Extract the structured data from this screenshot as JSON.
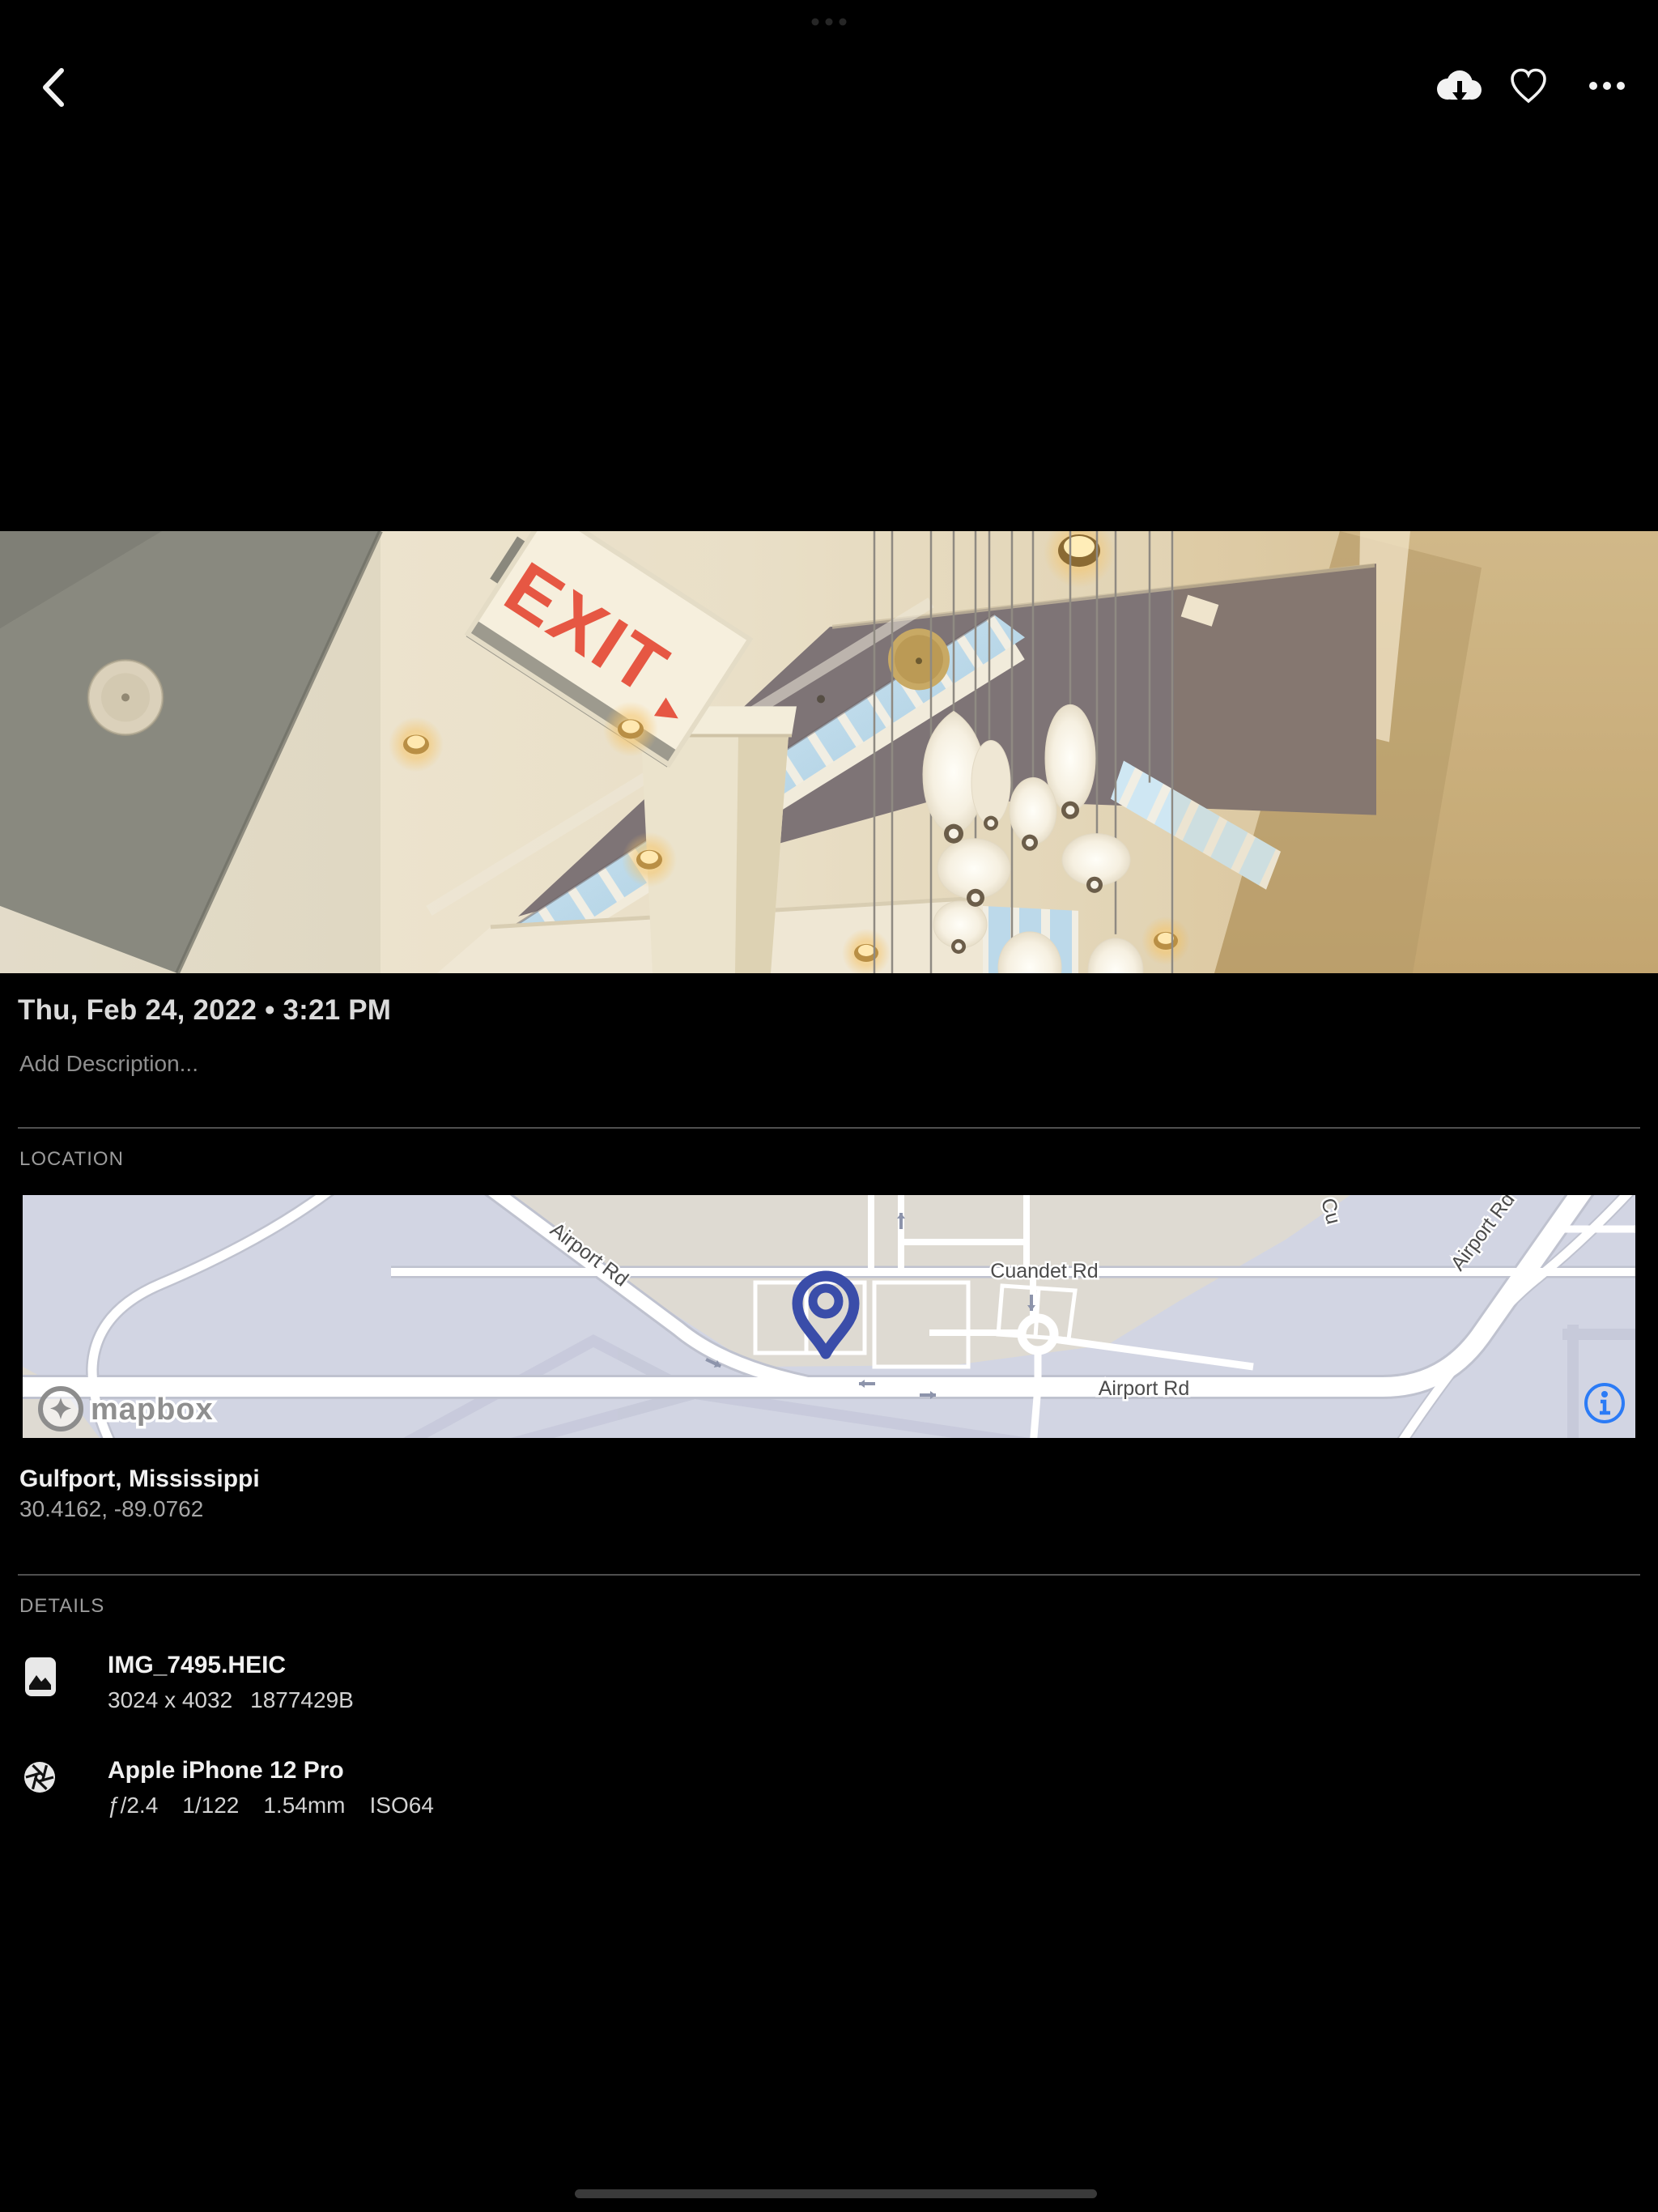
{
  "top_bar": {
    "back_icon": "chevron-left",
    "download_icon": "cloud-download",
    "favorite_icon": "heart-outline",
    "more_icon": "ellipsis-horizontal"
  },
  "photo_meta": {
    "datetime": "Thu, Feb 24, 2022 • 3:21 PM",
    "description_placeholder": "Add Description..."
  },
  "photo_content": {
    "exit_sign_text": "EXIT",
    "exit_sign_arrow": "▸"
  },
  "location": {
    "label": "LOCATION",
    "place": "Gulfport, Mississippi",
    "coordinates": "30.4162, -89.0762",
    "map": {
      "road_label_sw": "Airport Rd",
      "road_label_bottom": "Airport Rd",
      "road_label_ne": "Airport Rd",
      "road_label_cuandet": "Cuandet Rd",
      "road_label_partial": "Cu",
      "attribution": "mapbox"
    }
  },
  "details": {
    "label": "DETAILS",
    "file": {
      "name": "IMG_7495.HEIC",
      "dimensions": "3024 x 4032",
      "size": "1877429B"
    },
    "camera": {
      "name": "Apple iPhone 12 Pro",
      "aperture": "ƒ/2.4",
      "shutter_speed": "1/122",
      "focal_length": "1.54mm",
      "iso": "ISO64"
    }
  },
  "colors": {
    "background": "#000000",
    "map_pin": "#3a4da9",
    "info_icon": "#2b7bf6",
    "exit_text": "#e65743"
  }
}
